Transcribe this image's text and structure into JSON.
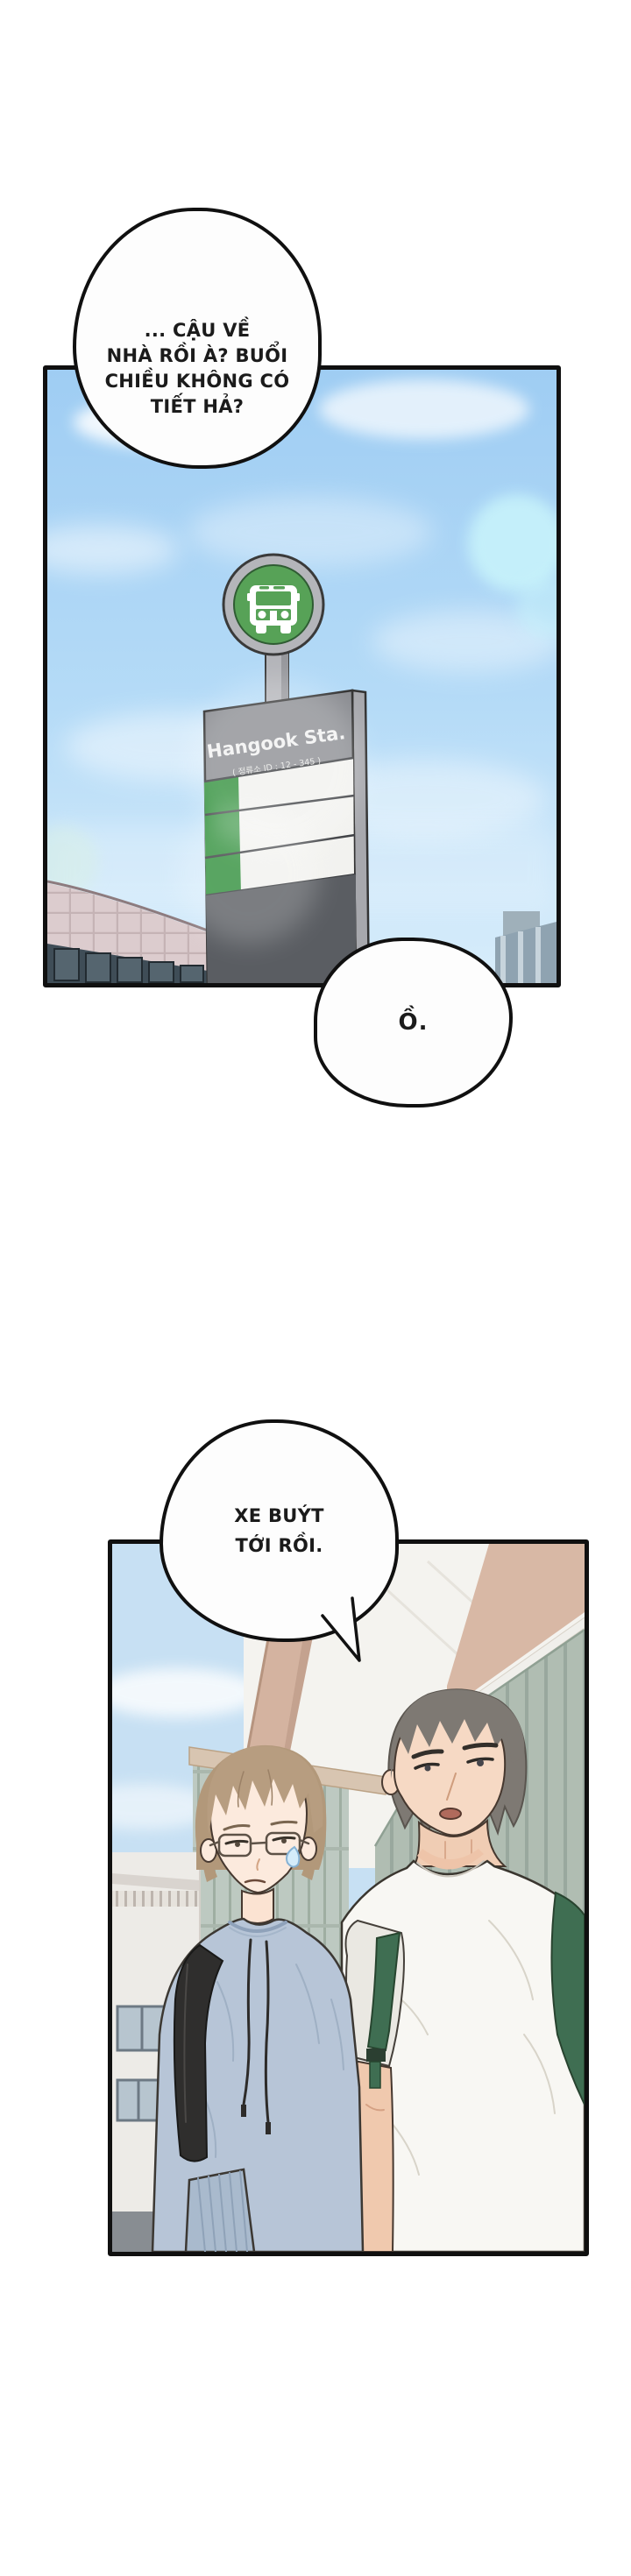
{
  "bubbles": {
    "dialogue_1": {
      "lines": [
        "... CẬU VỀ",
        "NHÀ RỒI À? BUỔI",
        "CHIỀU KHÔNG CÓ",
        "TIẾT HẢ?"
      ]
    },
    "dialogue_2": {
      "text": "Ồ."
    },
    "dialogue_3": {
      "lines": [
        "XE BUÝT",
        "TỚI RỒI."
      ]
    }
  },
  "bus_stop_sign": {
    "title": "Hangook Sta.",
    "subtitle": "( 정류소 ID : 12 - 345 )"
  },
  "colors": {
    "panel_border": "#101010",
    "bubble_fill": "#fdfdfd",
    "text": "#1b1b1b",
    "sky_top": "#9fcdf3",
    "sky_bottom": "#d8edfb",
    "bokeh_cyan": "#c9f4fb",
    "sign_green": "#57a257",
    "sign_gray": "#8a8c91",
    "board_white": "#f2f2ef",
    "board_green": "#2f8f3a",
    "board_dark": "#5a5d62",
    "pink_building": "#dcccce",
    "window_dark": "#3f4d57",
    "sky2": "#c7e0f3",
    "slat_green": "#b0bdb2",
    "tan": "#d8b8a5",
    "hair_left": "#b79d80",
    "hair_right": "#7e7973",
    "skin_left": "#fceadd",
    "skin_right": "#f6d9c4",
    "sweater_blue": "#b7c5d7",
    "tee_white": "#f8f7f3",
    "strap_green": "#3f6e52",
    "backpack_black": "#2f2e2d"
  }
}
